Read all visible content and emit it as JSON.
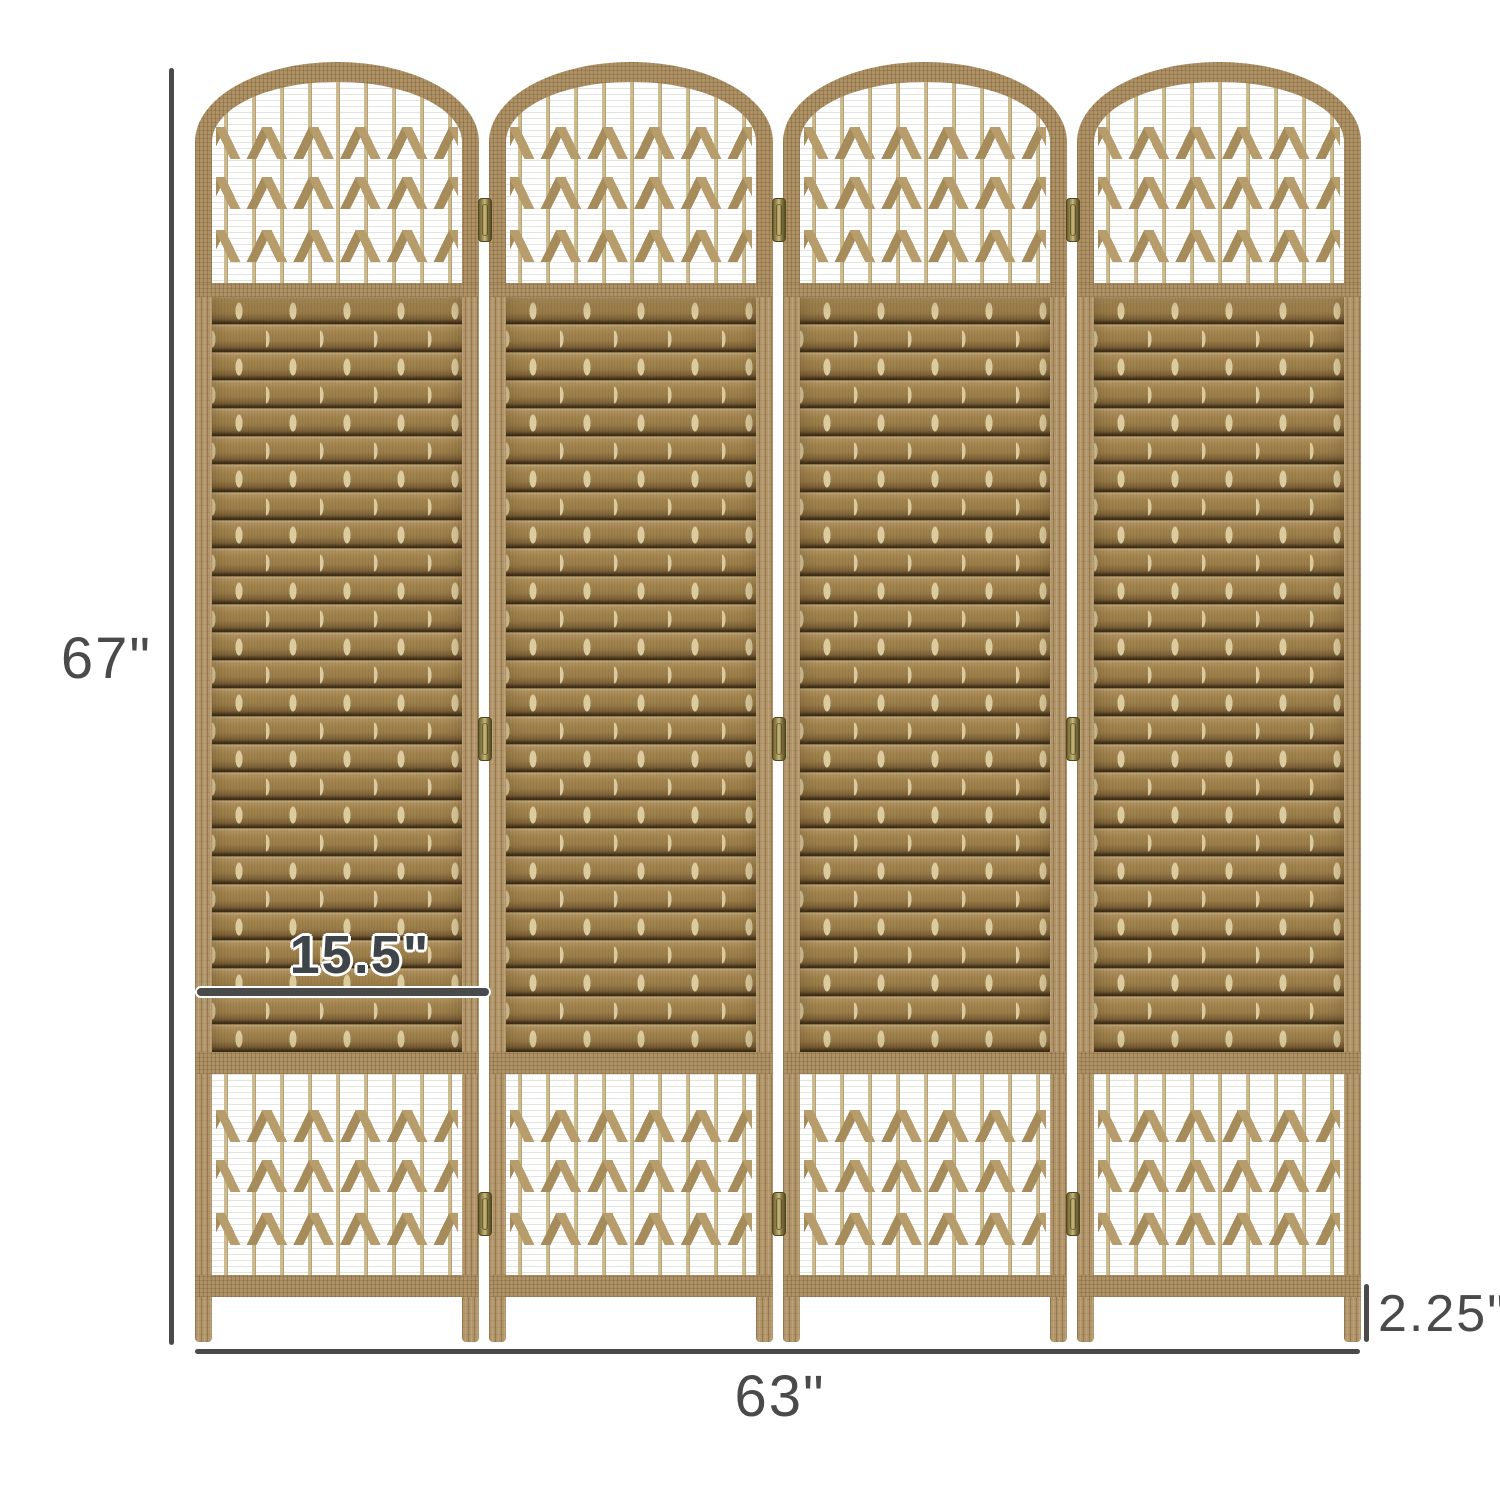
{
  "screen": {
    "panel_count": 4,
    "sections_per_panel": [
      "arched-top-lattice",
      "wicker-weave",
      "bottom-lattice"
    ],
    "cross_rows_per_lattice": 3,
    "hinges_per_gap": 3
  },
  "annotations": {
    "height_label": "67\"",
    "width_label": "63\"",
    "panel_width_label": "15.5\"",
    "foot_height_label": "2.25\""
  },
  "colors": {
    "background": "#ffffff",
    "dimension": "#4a4a4a",
    "wood_frame": "#b2966a",
    "weave": "#9f8251",
    "weave_tie": "#dccb9e",
    "lattice_stick": "#cbbb8e",
    "cross_weave": "#b89d6c",
    "hinge_brass": "#9f9055"
  }
}
